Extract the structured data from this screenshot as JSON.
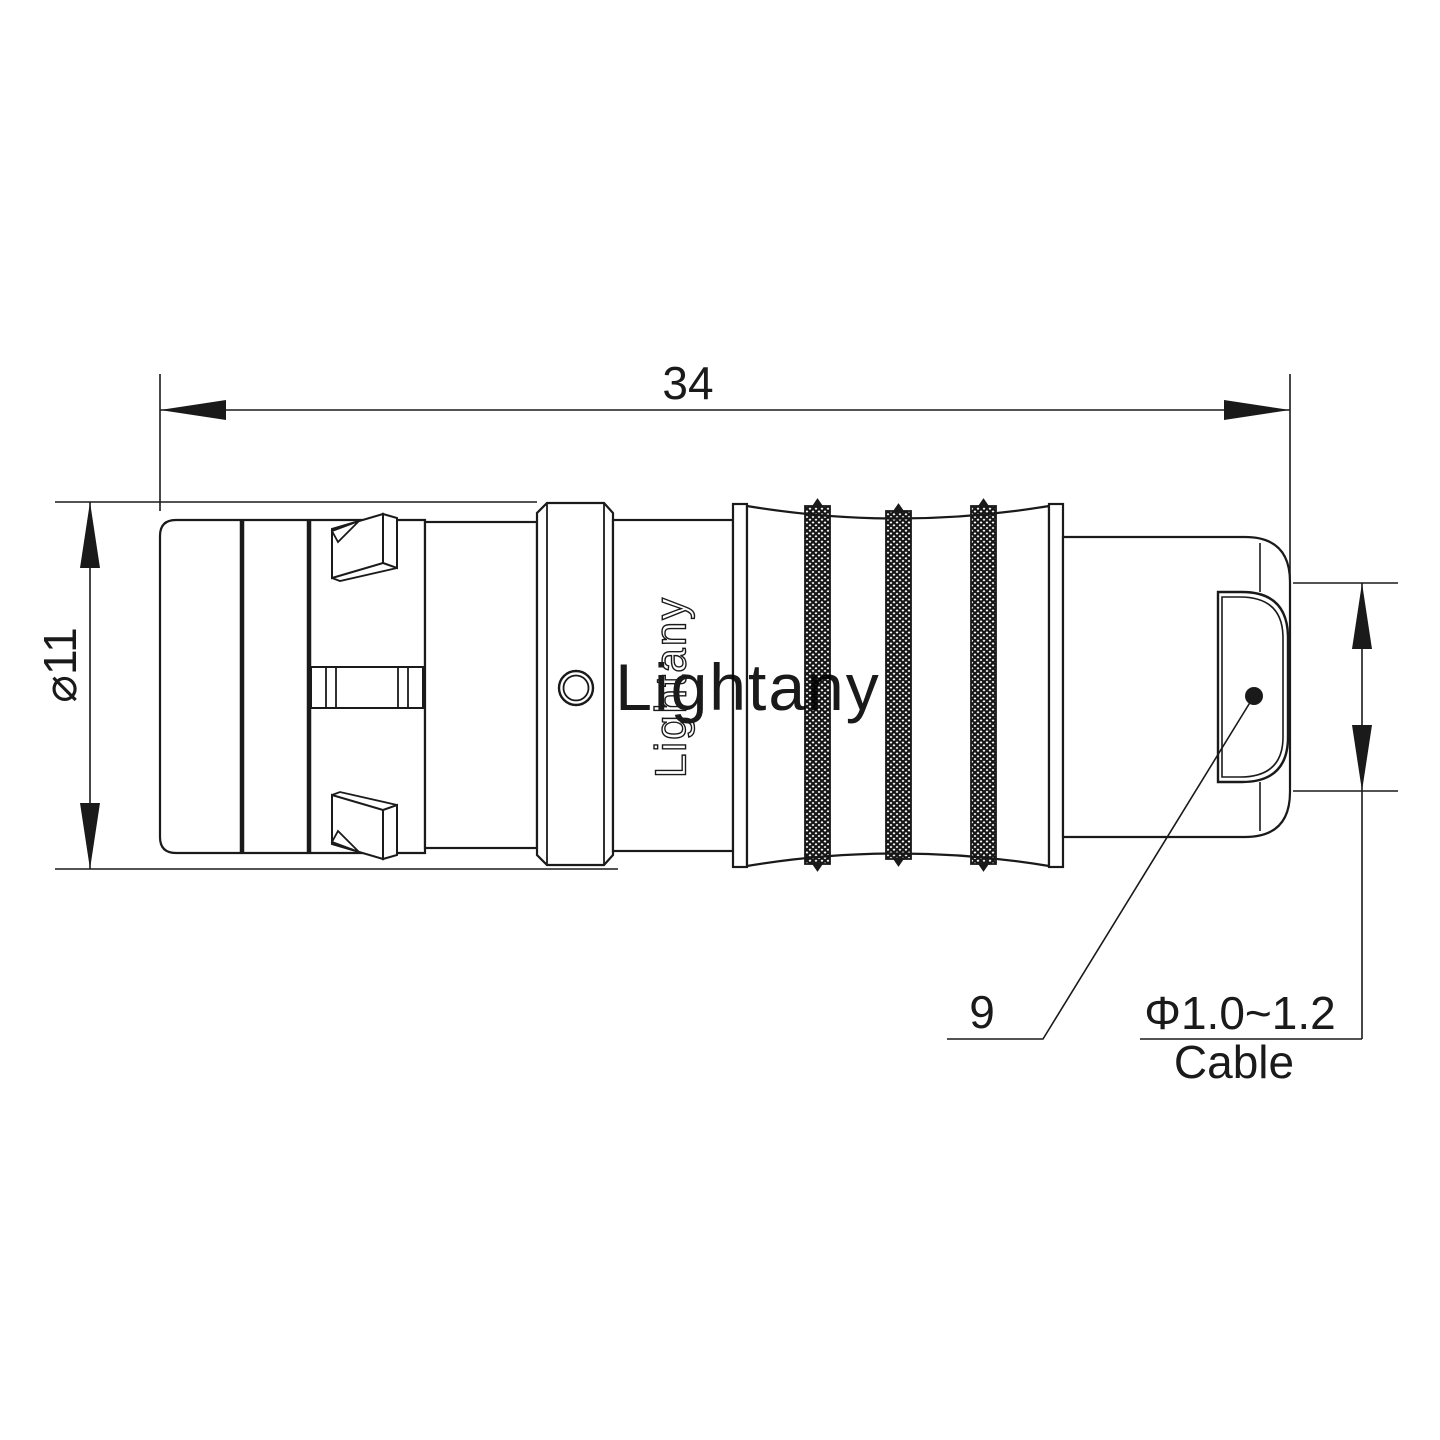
{
  "page": {
    "background": "#ffffff",
    "line_color": "#1a1a1a",
    "watermark_color": "#f0b2b2"
  },
  "dimensions": {
    "overall_length": "34",
    "outer_diameter": "⌀11",
    "rear_ref": "9",
    "cable_diameter_range": "Φ1.0~1.2",
    "cable_label": "Cable"
  },
  "branding": {
    "engraving": "Lightany",
    "watermark": "Lightany"
  }
}
